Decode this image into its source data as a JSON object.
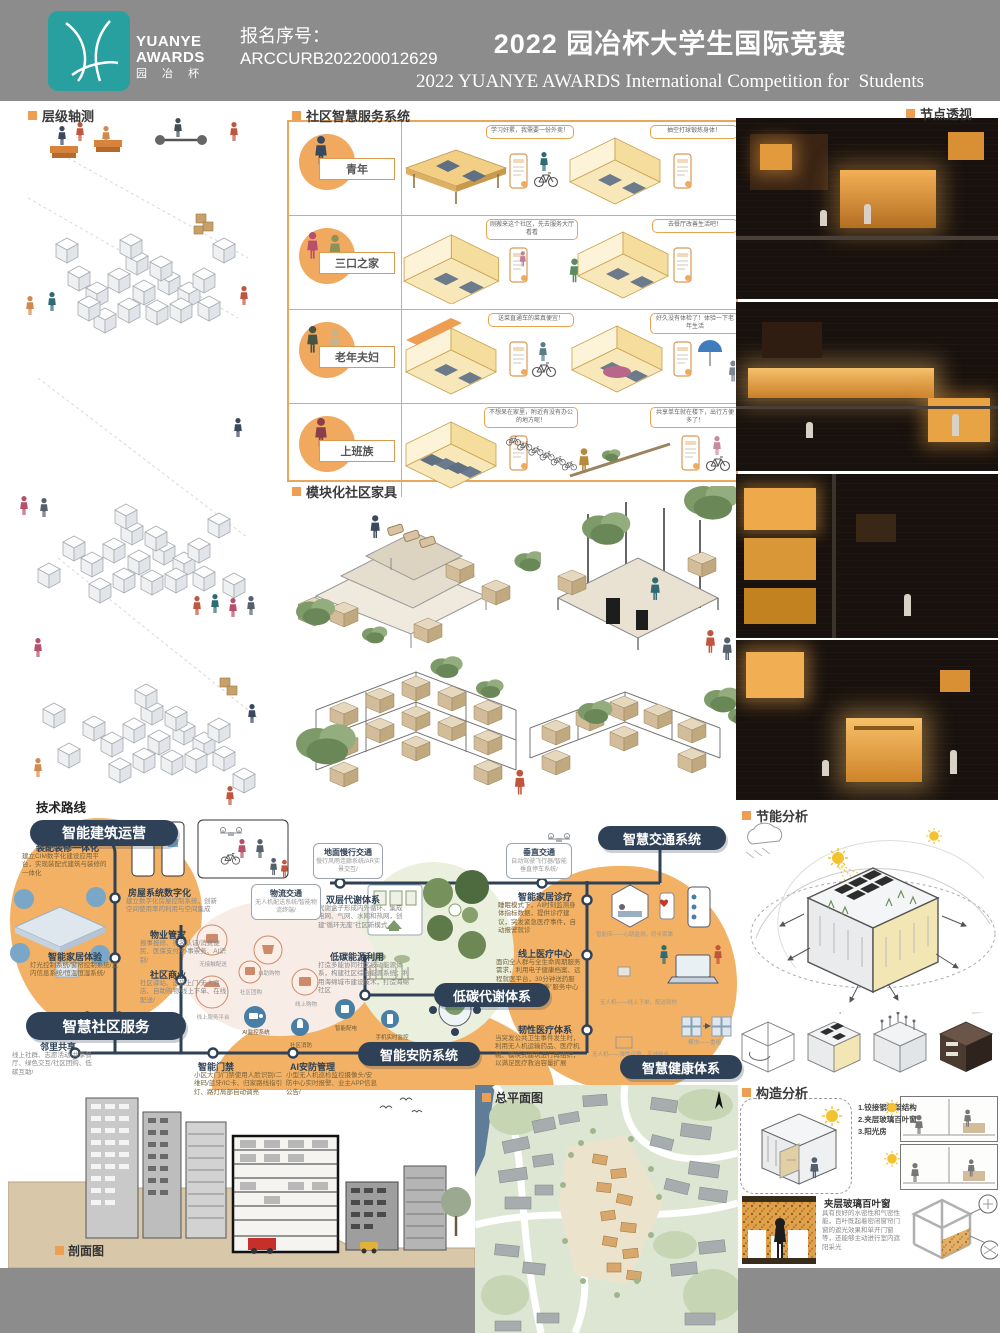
{
  "header": {
    "logo": {
      "line1": "YUANYE",
      "line2": "AWARDS",
      "line3": "园 冶 杯"
    },
    "reg_label": "报名序号：",
    "reg_no": "ARCCURB202200012629",
    "title_cn": "2022 园冶杯大学生国际竞赛",
    "title_en": "2022 YUANYE AWARDS International Competition for  Students"
  },
  "colors": {
    "accent": "#ED9E53",
    "navy": "#2E4156",
    "teal": "#28A09F",
    "header_gray": "#8C8C8C"
  },
  "sections": {
    "axon": {
      "title": "层级轴测"
    },
    "service": {
      "title": "社区智慧服务系统",
      "rows": [
        {
          "label": "青年",
          "bubble1": "学习好累，我需要一份外卖！",
          "bubble2": "抽空打球锻炼身体！"
        },
        {
          "label": "三口之家",
          "bubble1": "刚搬来这个社区，先去服务大厅看看",
          "bubble2": "去餐厅改善生活吧！"
        },
        {
          "label": "老年夫妇",
          "bubble1": "送菜直通车的菜真便宜！",
          "bubble2": "好久没有体检了！体验一下老年生活"
        },
        {
          "label": "上班族",
          "bubble1": "不想呆在家里，附近有没有办公的地方呢！",
          "bubble2": "共享单车就在楼下，出行方便多了！"
        }
      ]
    },
    "furniture": {
      "title": "模块化社区家具"
    },
    "node_view": {
      "title": "节点透视"
    },
    "energy": {
      "title": "节能分析"
    },
    "construction": {
      "title": "构造分析",
      "notes": [
        "1.铰接钢桁架结构",
        "2.夹层玻璃百叶窗",
        "3.阳光房"
      ],
      "window_name": "夹层玻璃百叶窗",
      "window_desc": "具有良好的水密性和气密性能，百叶既起着密闭窗帘门窗的遮光效果和单开门窗等，还能够主动进行室内遮阳采光"
    },
    "section_drawing": {
      "title": "剖面图"
    },
    "master_plan": {
      "title": "总平面图"
    }
  },
  "tech": {
    "title": "技术路线",
    "pills": {
      "building": "智能建筑运营",
      "community": "智慧社区服务",
      "traffic": "智慧交通系统",
      "carbon": "低碳代谢体系",
      "security": "智能安防系统",
      "health": "智慧健康体系"
    },
    "nodes": {
      "assembly": {
        "t": "装配装修一体化",
        "d": "建立CIM数字化建设应用平台，实现装配式建筑与装修的一体化"
      },
      "housing": {
        "t": "房屋系统数字化",
        "d": "建立数字化房屋控制系统，创新空间使用率的利用与空间集成"
      },
      "property": {
        "t": "物业管家",
        "d": "报事报修、实名认证/消费便民、医保支付/办事票务、AI识别/"
      },
      "smarthome": {
        "t": "智能家居体验",
        "d": "灯光控制系统/窗帘控制系统/室内信息系统/恒温恒湿系统/"
      },
      "commerce": {
        "t": "社区商业",
        "d": "社区驿站、送货上门/无人商店、自助购物/线上下单、在线配送/"
      },
      "share": {
        "t": "邻里共享",
        "d": "线上社群、志愿活动/共享餐厅、绿色交互/社区团购、低碳互助/"
      },
      "slow": {
        "t": "地面慢行交通",
        "d": "慢行风雨连廊系统/AR实景交互/"
      },
      "logistics": {
        "t": "物流交通",
        "d": "无人机配送系统/智能物流终端/"
      },
      "vertical": {
        "t": "垂直交通",
        "d": "自动驾驶飞行器/智能垂直停车系统/"
      },
      "metabolism": {
        "t": "双层代谢体系",
        "d": "代谢盒子形成内外循环、集成电网、气网、水网和热网，创建“循环无废”社区新模式"
      },
      "lowcarbon": {
        "t": "低碳能源利用",
        "d": "打造多能协同社区被动能源体系，构建社区综合能源系统；利用海绵城市建设技术，打造海绵社区"
      },
      "door": {
        "t": "智能门禁",
        "d": "小区大门/门禁使用人脸识别/二维码/蓝牙/IC卡、归家路线指引灯、路灯局部自动调亮"
      },
      "aisec": {
        "t": "AI安防管理",
        "d": "小型无人机巡检监控摄像头/安防中心实时报警、业主APP信息公告/"
      },
      "homemed": {
        "t": "智能家居诊疗",
        "d": "睡眠模式下，AI时刻监测身体指标数据，提供诊疗建议，突发紧急医疗事件，自动报警就诊",
        "cap": "智能床——心跳监测，同步家属"
      },
      "onlinemed": {
        "t": "线上医疗中心",
        "d": "面向全人群与全生命周期服务需求，利用电子健康档案、远程就医平台，30分钟送药服务，构建“全民康养”服务中心",
        "cap": "无人机——线上下单、配送到村"
      },
      "resilient": {
        "t": "韧性医疗体系",
        "d": "当突发公共卫生事件发生时，利用无人机运输药品、医疗机械、模块式建筑进行再组织，以满足医疗救治容量扩展",
        "cap1": "无人机——弹性运输，平战结合",
        "cap2": "模块——重组"
      }
    },
    "circles": [
      "无接触配送",
      "自助购物",
      "线上服务平台",
      "社区团购",
      "线上购物"
    ],
    "security_icons": [
      "AI监控系统",
      "社区消防",
      "智能配电",
      "手机实时监控"
    ]
  }
}
